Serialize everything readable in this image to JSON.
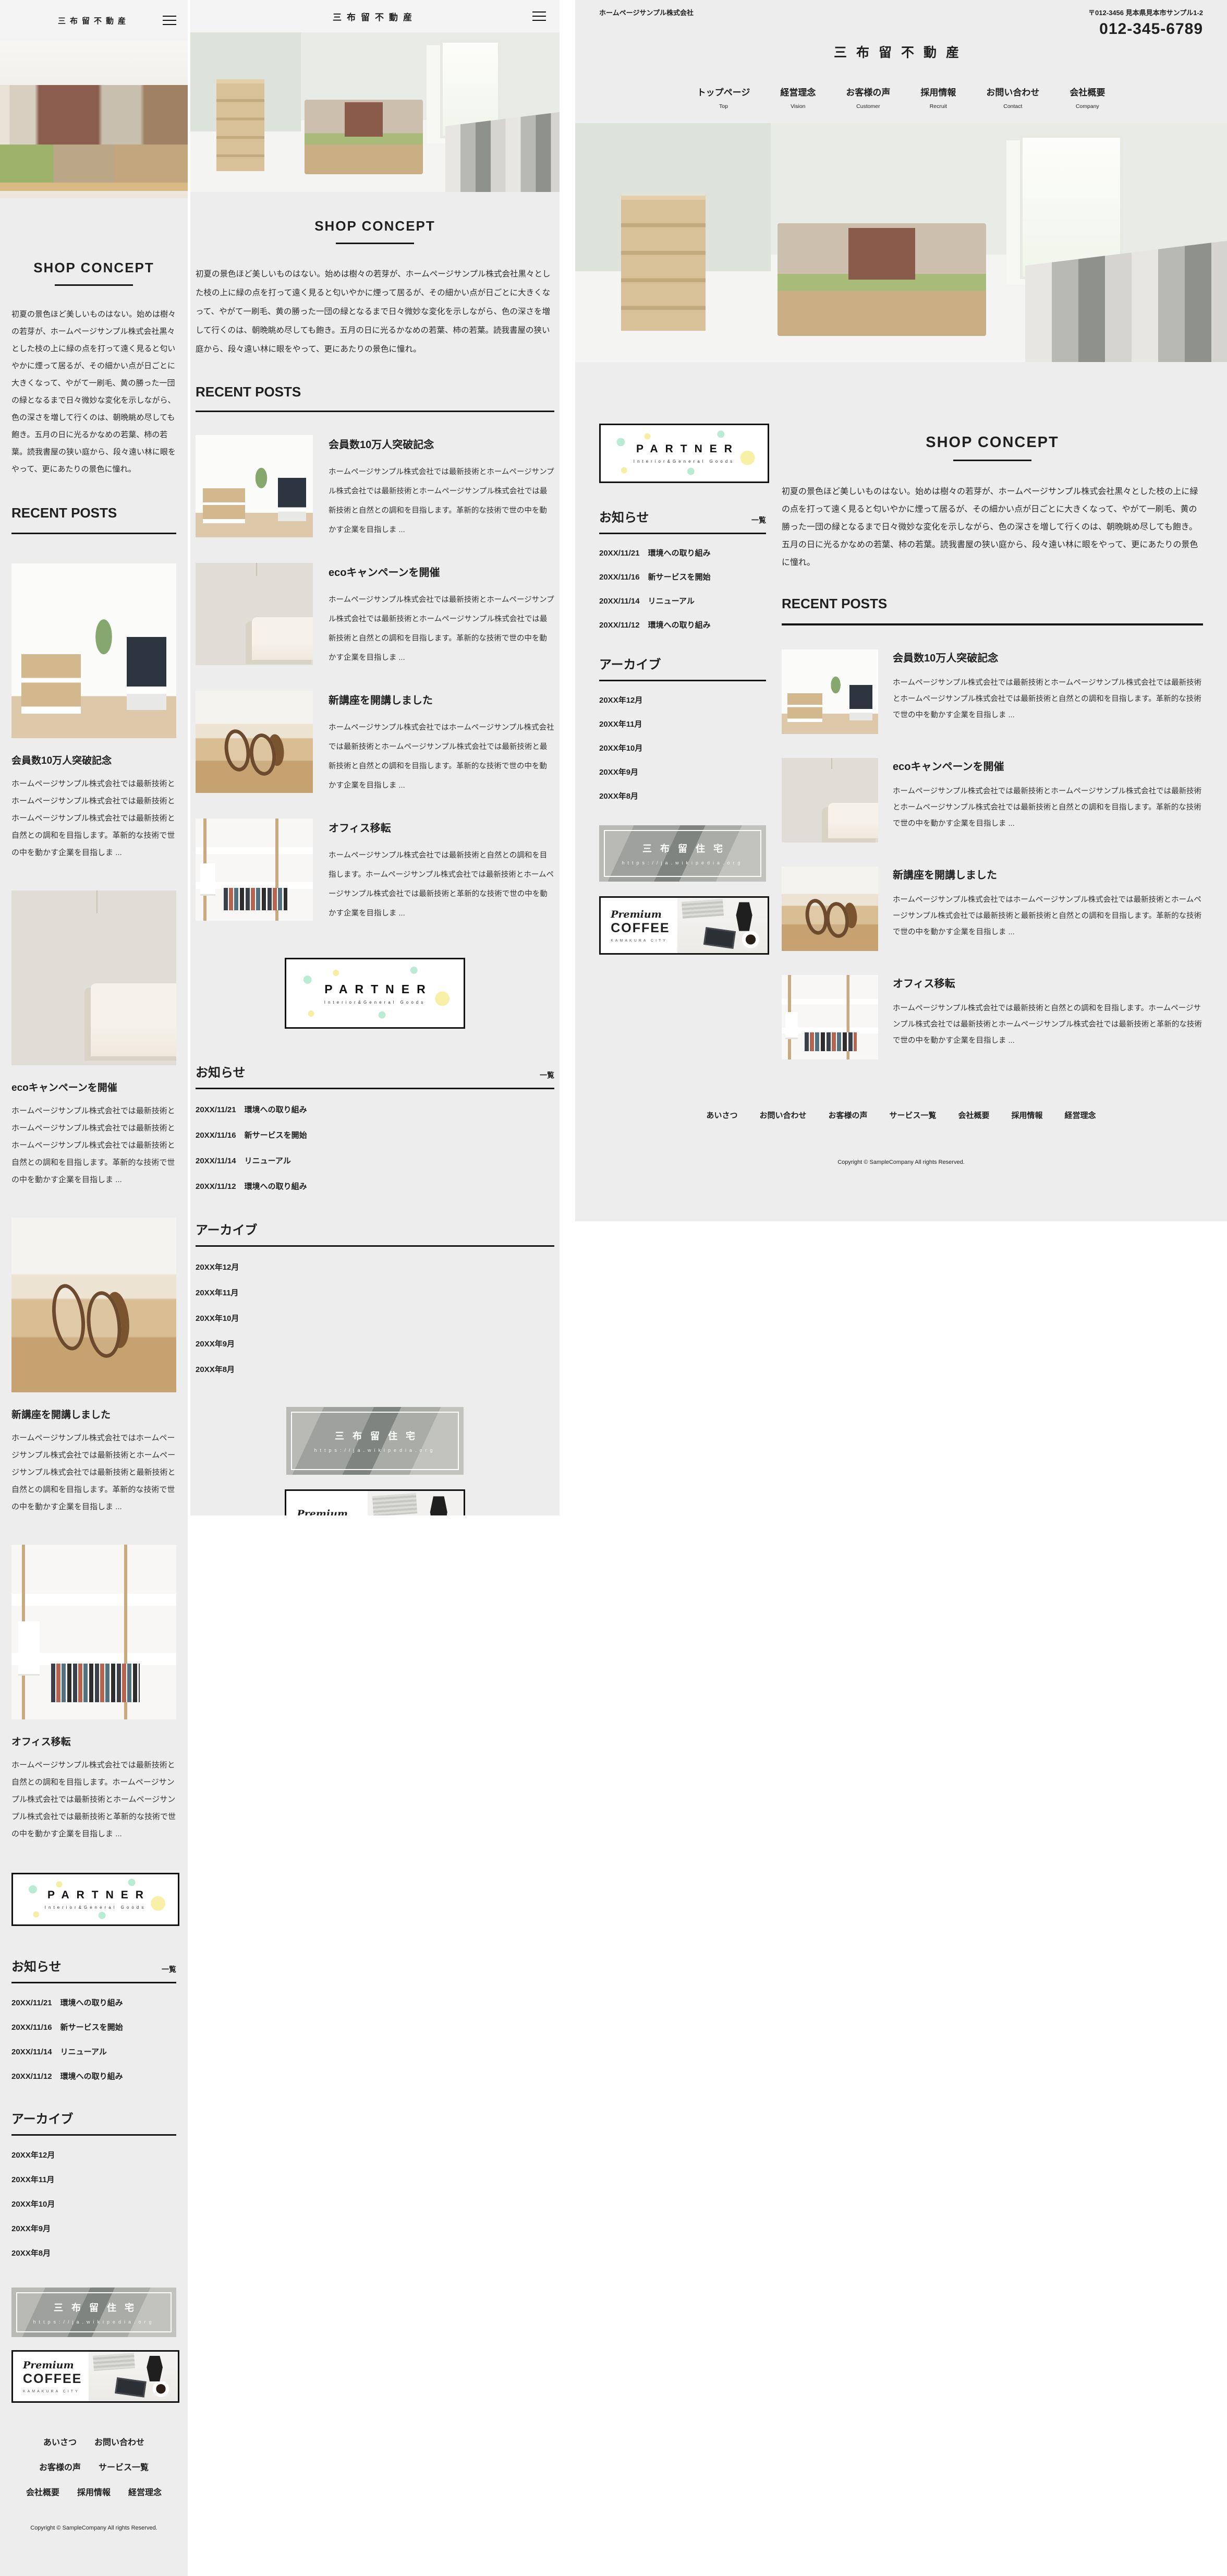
{
  "site": {
    "company_name": "ホームページサンプル株式会社",
    "logo": "三布留不動産",
    "address": "〒012-3456 見本県見本市サンプル1-2",
    "phone": "012-345-6789"
  },
  "nav": {
    "items": [
      {
        "label": "トップページ",
        "sub": "Top"
      },
      {
        "label": "経営理念",
        "sub": "Vision"
      },
      {
        "label": "お客様の声",
        "sub": "Customer"
      },
      {
        "label": "採用情報",
        "sub": "Recruit"
      },
      {
        "label": "お問い合わせ",
        "sub": "Contact"
      },
      {
        "label": "会社概要",
        "sub": "Company"
      }
    ]
  },
  "concept": {
    "heading": "SHOP CONCEPT",
    "body": "初夏の景色ほど美しいものはない。始めは樹々の若芽が、ホームページサンプル株式会社黒々とした枝の上に緑の点を打って遠く見ると匂いやかに煙って居るが、その細かい点が日ごとに大きくなって、やがて一刷毛、黄の勝った一団の緑となるまで日々微妙な変化を示しながら、色の深さを増して行くのは、朝晩眺め尽しても飽き。五月の日に光るかなめの若葉、柿の若葉。読我書屋の狭い庭から、段々遠い林に眼をやって、更にあたりの景色に憧れ。"
  },
  "recent": {
    "heading": "RECENT POSTS",
    "posts": [
      {
        "title": "会員数10万人突破記念",
        "image": "office-room",
        "body": "ホームページサンプル株式会社では最新技術とホームページサンプル株式会社では最新技術とホームページサンプル株式会社では最新技術と自然との調和を目指します。革新的な技術で世の中を動かす企業を目指しま ..."
      },
      {
        "title": "ecoキャンペーンを開催",
        "image": "bedroom",
        "body": "ホームページサンプル株式会社では最新技術とホームページサンプル株式会社では最新技術とホームページサンプル株式会社では最新技術と自然との調和を目指します。革新的な技術で世の中を動かす企業を目指しま ..."
      },
      {
        "title": "新講座を開講しました",
        "image": "glasses",
        "body": "ホームページサンプル株式会社ではホームページサンプル株式会社では最新技術とホームページサンプル株式会社では最新技術と最新技術と自然との調和を目指します。革新的な技術で世の中を動かす企業を目指しま ..."
      },
      {
        "title": "オフィス移転",
        "image": "bookshelf",
        "body": "ホームページサンプル株式会社では最新技術と自然との調和を目指します。ホームページサンプル株式会社では最新技術とホームページサンプル株式会社では最新技術と革新的な技術で世の中を動かす企業を目指しま ..."
      }
    ]
  },
  "partner": {
    "title": "PARTNER",
    "subtitle": "Interior&General Goods"
  },
  "news": {
    "heading": "お知らせ",
    "list_link": "一覧",
    "items": [
      {
        "date": "20XX/11/21",
        "title": "環境への取り組み"
      },
      {
        "date": "20XX/11/16",
        "title": "新サービスを開始"
      },
      {
        "date": "20XX/11/14",
        "title": "リニューアル"
      },
      {
        "date": "20XX/11/12",
        "title": "環境への取り組み"
      }
    ]
  },
  "archive": {
    "heading": "アーカイブ",
    "items": [
      "20XX年12月",
      "20XX年11月",
      "20XX年10月",
      "20XX年9月",
      "20XX年8月"
    ]
  },
  "banners": {
    "house": {
      "title": "三布留住宅",
      "url": "https://ja.wikipedia.org"
    },
    "coffee": {
      "line1": "Premium",
      "line2": "COFFEE",
      "line3": "KAMAKURA CITY"
    }
  },
  "footer": {
    "links": [
      "あいさつ",
      "お問い合わせ",
      "お客様の声",
      "サービス一覧",
      "会社概要",
      "採用情報",
      "経営理念"
    ],
    "copyright": "Copyright © SampleCompany All rights Reserved."
  },
  "colors": {
    "page_bg": "#ededed",
    "header_bg": "#f4f4f4",
    "text": "#1f1f1f",
    "rule": "#141414",
    "accent_mint": "#b9ecd2",
    "accent_yellow": "#f6efa3"
  }
}
